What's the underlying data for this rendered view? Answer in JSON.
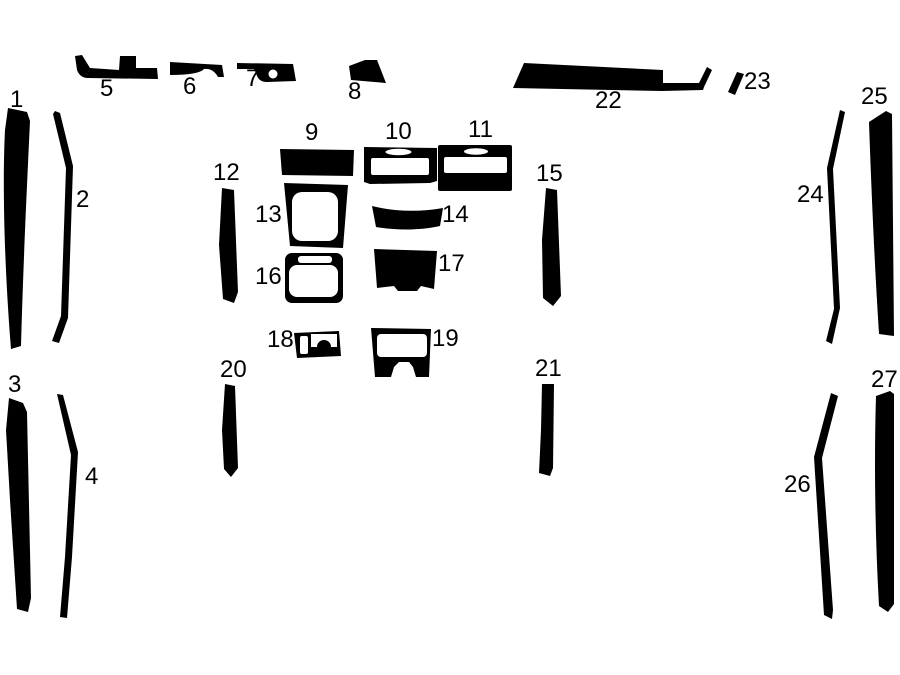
{
  "diagram": {
    "type": "dash-trim-kit-piece-layout",
    "canvas": {
      "width": 900,
      "height": 675
    }
  },
  "colors": {
    "background": "#ffffff",
    "piece": "#000000",
    "label": "#000000"
  },
  "pieces": [
    {
      "id": 1,
      "label": "1",
      "label_pos": [
        10,
        88
      ],
      "shape": {
        "path": "M8,108 L27,112 L30,121 C27,185 23,270 21,346 L11,349 C5,275 2,190 5,130 Z"
      },
      "cutouts": []
    },
    {
      "id": 2,
      "label": "2",
      "label_pos": [
        76,
        188
      ],
      "shape": {
        "path": "M55,111 L60,113 L73,166 L68,318 L59,343 L52,341 L61,316 L66,168 L53,114 Z"
      },
      "cutouts": []
    },
    {
      "id": 3,
      "label": "3",
      "label_pos": [
        8,
        373
      ],
      "shape": {
        "path": "M9,398 L23,403 L27,412 L31,598 L28,612 L17,609 L10,500 L6,430 Z"
      },
      "cutouts": []
    },
    {
      "id": 4,
      "label": "4",
      "label_pos": [
        85,
        465
      ],
      "shape": {
        "path": "M57,394 L63,395 L78,452 L72,557 L67,618 L60,617 L65,557 L71,455 Z"
      },
      "cutouts": []
    },
    {
      "id": 5,
      "label": "5",
      "label_pos": [
        100,
        77
      ],
      "shape": {
        "path": "M75,56 L82,55 L90,68 L119,70 L120,56 L136,56 L136,68 L157,68 L158,79 L88,78 Q80,78 77,70 Z"
      },
      "cutouts": []
    },
    {
      "id": 6,
      "label": "6",
      "label_pos": [
        183,
        75
      ],
      "shape": {
        "path": "M170,62 L222,65 L224,77 L218,77 Q213,68 204,69 Q199,75 170,75 Z"
      },
      "cutouts": []
    },
    {
      "id": 7,
      "label": "7",
      "label_pos": [
        246,
        67
      ],
      "shape": {
        "path": "M237,63 L293,64 L296,81 L267,82 Q258,82 256,73 L254,69 L237,69 Z"
      },
      "cutouts": [
        {
          "circle": [
            273,
            74,
            4.5
          ]
        }
      ]
    },
    {
      "id": 8,
      "label": "8",
      "label_pos": [
        348,
        80
      ],
      "shape": {
        "path": "M349,66 L365,60 L377,60 L386,83 L351,80 Z"
      },
      "cutouts": []
    },
    {
      "id": 9,
      "label": "9",
      "label_pos": [
        305,
        121
      ],
      "shape": {
        "path": "M280,149 L354,150 L353,176 L282,175 Z"
      },
      "cutouts": []
    },
    {
      "id": 10,
      "label": "10",
      "label_pos": [
        385,
        120
      ],
      "shape": {
        "path": "M364,147 L437,148 L437,181 L430,183 L370,184 L364,182 Z"
      },
      "cutouts": [
        {
          "ellipse": [
            398.5,
            152,
            13,
            3.2
          ]
        },
        {
          "rect": [
            371,
            158,
            58,
            17,
            2
          ]
        }
      ]
    },
    {
      "id": 11,
      "label": "11",
      "label_pos": [
        468,
        118
      ],
      "shape": {
        "rect": [
          438,
          145,
          74,
          46,
          2
        ]
      },
      "cutouts": [
        {
          "ellipse": [
            476,
            151.5,
            12,
            3.2
          ]
        },
        {
          "rect": [
            444,
            157,
            63,
            16,
            2
          ]
        }
      ]
    },
    {
      "id": 12,
      "label": "12",
      "label_pos": [
        213,
        161
      ],
      "shape": {
        "path": "M222,188 L234,190 L238,292 L234,303 L223,299 L219,245 Z"
      },
      "cutouts": []
    },
    {
      "id": 13,
      "label": "13",
      "label_pos": [
        255,
        203
      ],
      "shape": {
        "path": "M284,183 L348,185 L343,248 L290,246 Z"
      },
      "cutouts": [
        {
          "rect": [
            292,
            192,
            46,
            49,
            10
          ]
        }
      ]
    },
    {
      "id": 14,
      "label": "14",
      "label_pos": [
        442,
        203
      ],
      "shape": {
        "path": "M372,206 C396,212 420,212 443,208 L440,226 C417,231 394,230 376,227 Z"
      },
      "cutouts": []
    },
    {
      "id": 15,
      "label": "15",
      "label_pos": [
        536,
        162
      ],
      "shape": {
        "path": "M546,188 L557,190 L561,296 L553,306 L543,298 L542,240 Z"
      },
      "cutouts": []
    },
    {
      "id": 16,
      "label": "16",
      "label_pos": [
        255,
        265
      ],
      "shape": {
        "rect": [
          285,
          253,
          58,
          50,
          7
        ]
      },
      "cutouts": [
        {
          "rect": [
            298,
            256,
            34,
            7,
            3
          ]
        },
        {
          "rect": [
            289,
            265,
            49,
            32,
            8
          ]
        }
      ]
    },
    {
      "id": 17,
      "label": "17",
      "label_pos": [
        438,
        252
      ],
      "shape": {
        "path": "M374,249 L437,251 L434,289 L421,286 L417,291 L398,291 L394,286 L377,288 Z"
      },
      "cutouts": []
    },
    {
      "id": 18,
      "label": "18",
      "label_pos": [
        267,
        328
      ],
      "shape": {
        "path": "M294,333 L339,331 L341,356 L297,358 Z"
      },
      "cutouts": [
        {
          "rect": [
            300,
            336,
            8,
            18,
            2
          ]
        },
        {
          "path": "M311,334 L337,334 L337,347 L331,347 A7,7 0 0 0 317,347 L311,347 Z"
        }
      ]
    },
    {
      "id": 19,
      "label": "19",
      "label_pos": [
        432,
        327
      ],
      "shape": {
        "path": "M371,328 L431,329 L429,377 L375,377 Z"
      },
      "cutouts": [
        {
          "rect": [
            377,
            334,
            50,
            23,
            4
          ]
        },
        {
          "path": "M391,377 L394,367 L399,362 L409,362 L413,367 L416,377 Z"
        }
      ]
    },
    {
      "id": 20,
      "label": "20",
      "label_pos": [
        220,
        358
      ],
      "shape": {
        "path": "M225,384 L235,386 L238,468 L231,477 L224,469 L222,430 Z"
      },
      "cutouts": []
    },
    {
      "id": 21,
      "label": "21",
      "label_pos": [
        535,
        357
      ],
      "shape": {
        "path": "M542,384 L554,384 L553,468 L550,476 L539,473 L541,430 Z"
      },
      "cutouts": []
    },
    {
      "id": 22,
      "label": "22",
      "label_pos": [
        595,
        89
      ],
      "shape": {
        "path": "M524,63 L663,70 L663,83 L699,83 L707,67 L712,70 L704,87 L703,90 L662,91 L513,88 Z"
      },
      "cutouts": []
    },
    {
      "id": 23,
      "label": "23",
      "label_pos": [
        744,
        70
      ],
      "shape": {
        "path": "M737,72 L744,74 L735,95 L728,92 Z"
      },
      "cutouts": []
    },
    {
      "id": 24,
      "label": "24",
      "label_pos": [
        797,
        183
      ],
      "shape": {
        "path": "M840,110 L845,112 L833,169 L840,308 L832,344 L826,341 L834,309 L827,168 Z"
      },
      "cutouts": []
    },
    {
      "id": 25,
      "label": "25",
      "label_pos": [
        861,
        85
      ],
      "shape": {
        "path": "M869,122 L886,111 L892,114 L894,336 L879,334 C874,255 871,180 869,122 Z"
      },
      "cutouts": []
    },
    {
      "id": 26,
      "label": "26",
      "label_pos": [
        784,
        473
      ],
      "shape": {
        "path": "M831,393 L838,396 L822,458 L833,610 L832,619 L824,615 L814,457 Z"
      },
      "cutouts": []
    },
    {
      "id": 27,
      "label": "27",
      "label_pos": [
        871,
        368
      ],
      "shape": {
        "path": "M876,396 L890,391 L894,394 L894,604 L888,612 L879,606 C875,535 874,460 876,396 Z"
      },
      "cutouts": []
    }
  ]
}
